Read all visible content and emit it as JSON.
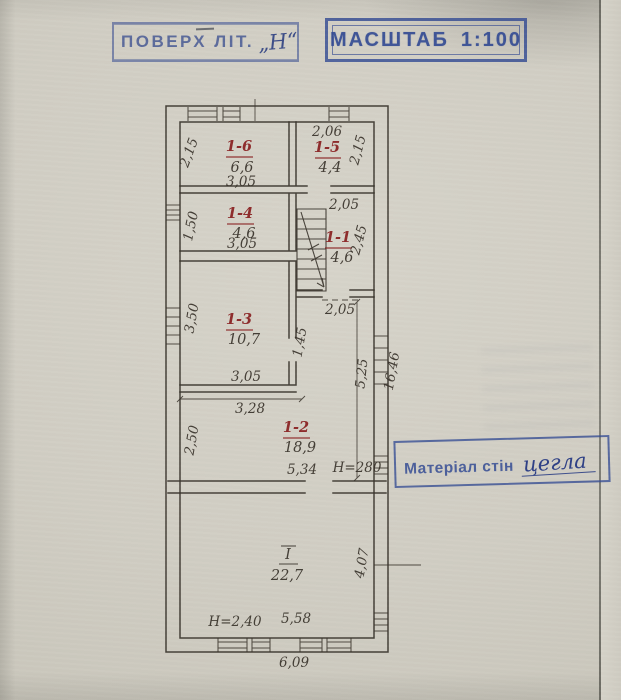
{
  "stamps": {
    "floor": {
      "label": "ПОВЕРХ ЛІТ.",
      "value": "„Н“"
    },
    "scale": {
      "label": "МАСШТАБ",
      "value": "1:100"
    },
    "material": {
      "label": "Матеріал стін",
      "value": "цегла"
    }
  },
  "plan": {
    "rooms": {
      "r16": {
        "num": "1-6",
        "area": "6,6"
      },
      "r15": {
        "num": "1-5",
        "area": "4,4"
      },
      "r14": {
        "num": "1-4",
        "area": "4,6"
      },
      "r11": {
        "num": "1-1",
        "area": "4,6"
      },
      "r13": {
        "num": "1-3",
        "area": "10,7"
      },
      "r12": {
        "num": "1-2",
        "area": "18,9"
      },
      "rI": {
        "num": "І",
        "area": "22,7"
      }
    },
    "dims": {
      "h16": "2,15",
      "w16": "3,05",
      "w15": "2,06",
      "h15": "2,15",
      "hall_top": "2,05",
      "h14": "1,50",
      "w14": "3,05",
      "h11": "2,45",
      "h13": "3,50",
      "w13": "3,05",
      "w13b": "3,28",
      "hall_bot": "2,05",
      "j13": "1,45",
      "right_inner": "5,25",
      "right_total": "16,46",
      "h12": "2,50",
      "w12": "5,34",
      "ceil12": "Н=280",
      "ceilI": "Н=2,40",
      "wI": "5,58",
      "hI": "4,07",
      "w_total": "6,09"
    },
    "colors": {
      "ink": "#3a342c",
      "room_red": "#8b2424",
      "stamp_blue": "#34509b"
    }
  }
}
